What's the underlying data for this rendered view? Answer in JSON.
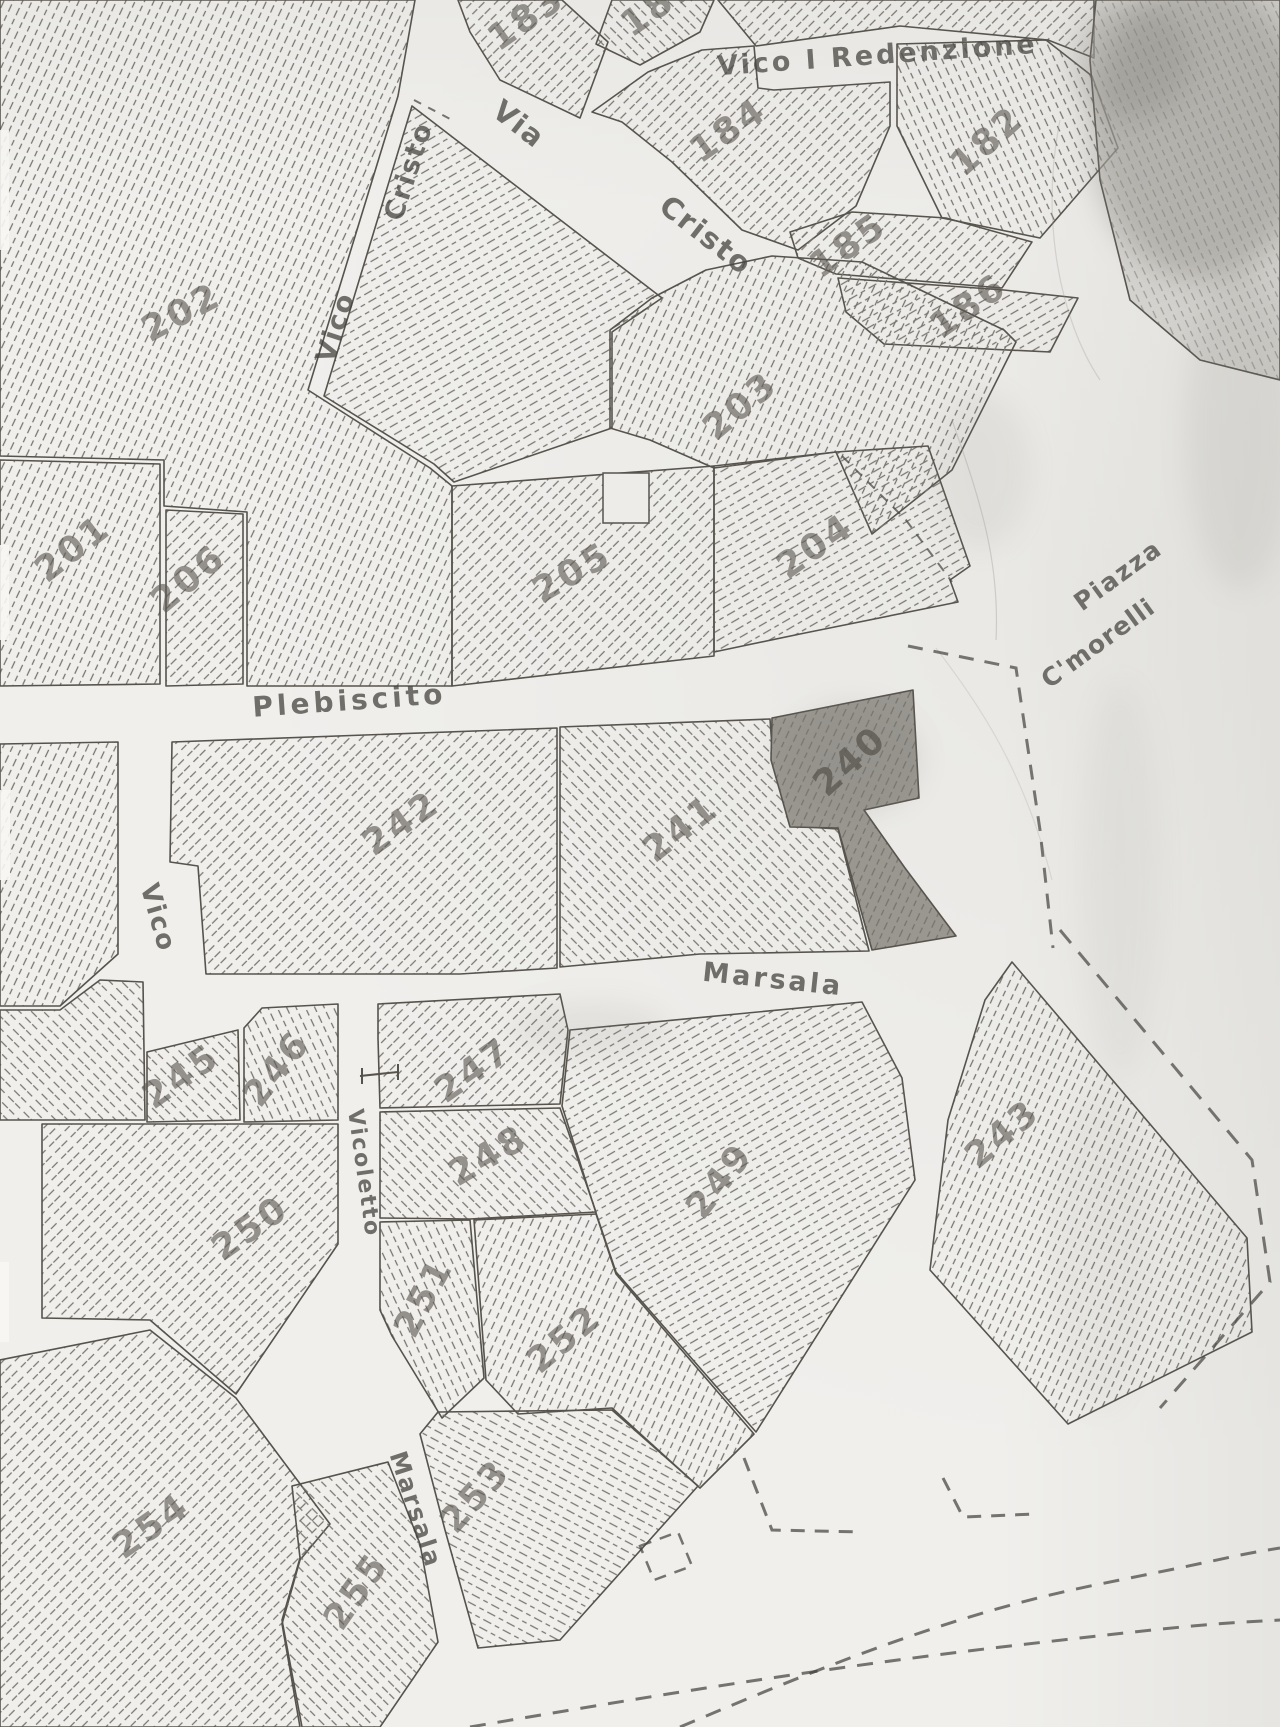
{
  "map": {
    "colors": {
      "paper": "#f0efec",
      "boundary": "#56534c",
      "hatch": "#76736c",
      "highlight_fill": "#9b9892",
      "number_ink": "#5c5952",
      "street_ink": "#45433e",
      "dash_ink": "#45433f",
      "smudge": "#85837d"
    },
    "street_labels": [
      {
        "text": "Vico I Redenzione",
        "x": 878,
        "y": 64,
        "rot": -4,
        "size": 27,
        "ls": 3
      },
      {
        "text": "Via",
        "x": 513,
        "y": 132,
        "rot": 38,
        "size": 29,
        "ls": 2
      },
      {
        "text": "Cristo",
        "x": 700,
        "y": 243,
        "rot": 38,
        "size": 29,
        "ls": 2
      },
      {
        "text": "Cristo",
        "x": 417,
        "y": 174,
        "rot": -72,
        "size": 27,
        "ls": 2
      },
      {
        "text": "Vico",
        "x": 344,
        "y": 330,
        "rot": -72,
        "size": 27,
        "ls": 2
      },
      {
        "text": "Plebiscito",
        "x": 350,
        "y": 710,
        "rot": -4,
        "size": 28,
        "ls": 4
      },
      {
        "text": "Piazza",
        "x": 1123,
        "y": 582,
        "rot": -36,
        "size": 25,
        "ls": 2
      },
      {
        "text": "C'morelli",
        "x": 1103,
        "y": 650,
        "rot": -36,
        "size": 25,
        "ls": 1
      },
      {
        "text": "Vico",
        "x": 150,
        "y": 920,
        "rot": 74,
        "size": 26,
        "ls": 2
      },
      {
        "text": "Marsala",
        "x": 772,
        "y": 988,
        "rot": 6,
        "size": 27,
        "ls": 3
      },
      {
        "text": "Vicoletto",
        "x": 357,
        "y": 1174,
        "rot": 82,
        "size": 22,
        "ls": 2
      },
      {
        "text": "Marsala",
        "x": 408,
        "y": 1512,
        "rot": 72,
        "size": 24,
        "ls": 2
      }
    ],
    "parcels": [
      {
        "number": "202",
        "hatch": "A",
        "points": "0,0 415,0 398,96 308,390 430,468 452,486 452,686 247,686 247,512 164,506 164,460 0,456",
        "label": {
          "x": 187,
          "y": 323,
          "rot": -28
        }
      },
      {
        "number": "",
        "hatch": "C",
        "points": "412,106 662,298 612,332 612,428 454,482 434,464 324,396"
      },
      {
        "number": "183",
        "hatch": "B",
        "points": "458,0 562,0 608,42 580,118 500,80 470,32",
        "label": {
          "x": 533,
          "y": 28,
          "rot": -35
        }
      },
      {
        "number": "181",
        "hatch": "E",
        "points": "612,0 714,0 700,32 640,65 596,44",
        "label": {
          "x": 666,
          "y": 14,
          "rot": -35
        }
      },
      {
        "number": "",
        "hatch": "B",
        "points": "718,0 1094,0 1094,58 1048,40 900,26 756,46"
      },
      {
        "number": "184",
        "hatch": "B",
        "points": "758,88 774,90 890,82 890,126 856,206 798,250 742,230 672,162 622,122 592,112 648,72 702,50 754,46",
        "label": {
          "x": 735,
          "y": 140,
          "rot": -35
        }
      },
      {
        "number": "182",
        "hatch": "D",
        "points": "897,44 1046,40 1092,76 1118,148 1040,238 942,218 897,126",
        "label": {
          "x": 995,
          "y": 150,
          "rot": -42
        }
      },
      {
        "number": "185",
        "hatch": "B",
        "points": "790,232 852,212 946,218 1032,242 1002,288 836,274 798,258",
        "label": {
          "x": 855,
          "y": 255,
          "rot": -35
        }
      },
      {
        "number": "186",
        "hatch": "C",
        "points": "838,278 1004,290 1078,298 1050,352 884,344 846,312",
        "label": {
          "x": 975,
          "y": 316,
          "rot": -35
        }
      },
      {
        "number": "203",
        "hatch": "A",
        "points": "610,330 652,298 706,270 772,256 862,262 1004,330 1016,342 952,470 872,534 836,452 714,468 650,440 610,428",
        "label": {
          "x": 748,
          "y": 415,
          "rot": -40
        }
      },
      {
        "number": "201",
        "hatch": "A",
        "points": "0,460 160,464 160,684 0,686",
        "label": {
          "x": 80,
          "y": 558,
          "rot": -38
        }
      },
      {
        "number": "206",
        "hatch": "B",
        "points": "166,510 243,514 243,684 166,686",
        "label": {
          "x": 196,
          "y": 588,
          "rot": -40
        }
      },
      {
        "number": "205",
        "hatch": "B",
        "points": "452,486 714,466 714,656 452,686",
        "label": {
          "x": 578,
          "y": 583,
          "rot": -30
        }
      },
      {
        "number": "204",
        "hatch": "C",
        "points": "714,466 836,452 928,446 970,566 950,580 958,602 800,634 714,652",
        "label": {
          "x": 822,
          "y": 556,
          "rot": -35
        }
      },
      {
        "number": "242",
        "hatch": "B",
        "points": "172,742 557,728 557,968 460,974 206,974 198,866 170,862",
        "label": {
          "x": 408,
          "y": 833,
          "rot": -35
        }
      },
      {
        "number": "241",
        "hatch": "E",
        "points": "560,727 770,719 773,762 790,826 838,829 869,951 700,954 560,967",
        "label": {
          "x": 688,
          "y": 838,
          "rot": -38
        }
      },
      {
        "number": "240",
        "hatch": "A",
        "dark": true,
        "points": "772,718 913,690 919,798 864,810 905,868 956,936 872,950 838,828 790,827 771,760",
        "label": {
          "x": 858,
          "y": 770,
          "rot": -42
        }
      },
      {
        "number": "",
        "hatch": "A",
        "points": "0,744 118,742 118,954 60,1006 0,1006"
      },
      {
        "number": "",
        "hatch": "E",
        "points": "0,1010 60,1010 100,980 143,982 145,1120 0,1120"
      },
      {
        "number": "245",
        "hatch": "E",
        "points": "147,1052 238,1030 240,1120 147,1122",
        "label": {
          "x": 188,
          "y": 1086,
          "rot": -35
        }
      },
      {
        "number": "246",
        "hatch": "D",
        "points": "244,1028 262,1008 338,1004 338,1120 244,1122",
        "label": {
          "x": 286,
          "y": 1076,
          "rot": -52
        }
      },
      {
        "number": "247",
        "hatch": "B",
        "points": "378,1004 560,994 568,1030 560,1104 380,1108 378,1038",
        "label": {
          "x": 480,
          "y": 1080,
          "rot": -35
        }
      },
      {
        "number": "248",
        "hatch": "E",
        "points": "380,1112 560,1108 596,1212 470,1219 380,1218",
        "label": {
          "x": 494,
          "y": 1166,
          "rot": -30
        }
      },
      {
        "number": "249",
        "hatch": "C",
        "points": "570,1030 862,1002 902,1078 915,1180 756,1432 616,1272 596,1213 562,1106",
        "label": {
          "x": 729,
          "y": 1188,
          "rot": -52
        }
      },
      {
        "number": "243",
        "hatch": "A",
        "points": "1012,962 1247,1238 1252,1332 1068,1424 930,1270 948,1120 985,1000",
        "label": {
          "x": 1010,
          "y": 1143,
          "rot": -40
        }
      },
      {
        "number": "250",
        "hatch": "B",
        "points": "42,1124 338,1124 338,1244 236,1394 150,1320 42,1318",
        "label": {
          "x": 257,
          "y": 1238,
          "rot": -35
        }
      },
      {
        "number": "251",
        "hatch": "D",
        "points": "380,1222 470,1220 484,1378 442,1418 392,1336 380,1310",
        "label": {
          "x": 434,
          "y": 1303,
          "rot": -62
        }
      },
      {
        "number": "252",
        "hatch": "A",
        "points": "474,1220 596,1214 616,1274 754,1434 700,1488 612,1408 518,1414 486,1380",
        "label": {
          "x": 572,
          "y": 1348,
          "rot": -40
        }
      },
      {
        "number": "253",
        "hatch": "F",
        "points": "438,1412 612,1410 698,1486 560,1640 478,1648 445,1530 420,1434",
        "label": {
          "x": 484,
          "y": 1504,
          "rot": -48
        }
      },
      {
        "number": "254",
        "hatch": "B",
        "points": "0,1360 150,1330 236,1398 330,1524 300,1560 282,1624 300,1727 0,1727",
        "label": {
          "x": 158,
          "y": 1536,
          "rot": -35
        }
      },
      {
        "number": "255",
        "hatch": "E",
        "points": "292,1486 388,1462 420,1544 438,1642 380,1727 302,1727 282,1620 300,1558",
        "label": {
          "x": 366,
          "y": 1598,
          "rot": -55
        }
      },
      {
        "number": "",
        "hatch": "D",
        "smudge": true,
        "points": "1096,0 1280,0 1280,380 1200,360 1130,300 1100,180 1090,60"
      }
    ],
    "dashed_lines": [
      {
        "d": "M908,646 L1016,668 L1040,830 L1053,948",
        "w": 3,
        "dash": "15 11"
      },
      {
        "d": "M1060,930 L1252,1160 L1270,1282 L1160,1408",
        "w": 3,
        "dash": "17 12"
      },
      {
        "d": "M744,1458 L772,1530 L862,1532",
        "w": 3,
        "dash": "14 10"
      },
      {
        "d": "M943,1478 L963,1517 L1035,1514",
        "w": 3,
        "dash": "14 10"
      },
      {
        "d": "M640,1546 L678,1532 L692,1566 L654,1580 Z",
        "w": 2.5,
        "dash": "12 9"
      },
      {
        "d": "M680,1727 C820,1668 950,1614 1100,1584 S1230,1556 1280,1548",
        "w": 3,
        "dash": "16 12"
      },
      {
        "d": "M470,1727 C640,1698 820,1668 1010,1646 S1210,1624 1280,1620",
        "w": 3,
        "dash": "16 12"
      },
      {
        "d": "M414,100 L452,120",
        "w": 2,
        "dash": "8 8"
      },
      {
        "d": "M842,456 L906,520 L952,582",
        "w": 2,
        "dash": "10 8"
      }
    ],
    "artifacts": {
      "building_notch": {
        "x": 603,
        "y": 473,
        "w": 46,
        "h": 50
      },
      "junction_cross": "M362,1068 L362,1084 M360,1076 L398,1072 M398,1064 L398,1080",
      "edge_strips": [
        {
          "x": 0,
          "y": 130,
          "w": 9,
          "h": 120
        },
        {
          "x": 0,
          "y": 545,
          "w": 9,
          "h": 95
        },
        {
          "x": 0,
          "y": 790,
          "w": 10,
          "h": 90
        },
        {
          "x": 0,
          "y": 1262,
          "w": 9,
          "h": 80
        }
      ],
      "smudges": [
        {
          "cx": 1200,
          "cy": 130,
          "rx": 110,
          "ry": 150,
          "o": 0.38
        },
        {
          "cx": 1130,
          "cy": 60,
          "rx": 60,
          "ry": 60,
          "o": 0.3
        },
        {
          "cx": 1240,
          "cy": 430,
          "rx": 55,
          "ry": 160,
          "o": 0.12
        },
        {
          "cx": 980,
          "cy": 470,
          "rx": 50,
          "ry": 80,
          "o": 0.1
        },
        {
          "cx": 1120,
          "cy": 880,
          "rx": 40,
          "ry": 200,
          "o": 0.07
        },
        {
          "cx": 1100,
          "cy": 1250,
          "rx": 50,
          "ry": 160,
          "o": 0.06
        },
        {
          "cx": 590,
          "cy": 1030,
          "rx": 80,
          "ry": 28,
          "o": 0.12
        },
        {
          "cx": 850,
          "cy": 760,
          "rx": 70,
          "ry": 55,
          "o": 0.18
        }
      ],
      "scratches": [
        {
          "d": "M952,420 C980,500 1000,560 996,640",
          "o": 0.35
        },
        {
          "d": "M1060,120 C1040,220 1060,320 1100,380",
          "o": 0.3
        },
        {
          "d": "M936,648 C980,706 1024,770 1052,880",
          "o": 0.22
        }
      ]
    }
  }
}
